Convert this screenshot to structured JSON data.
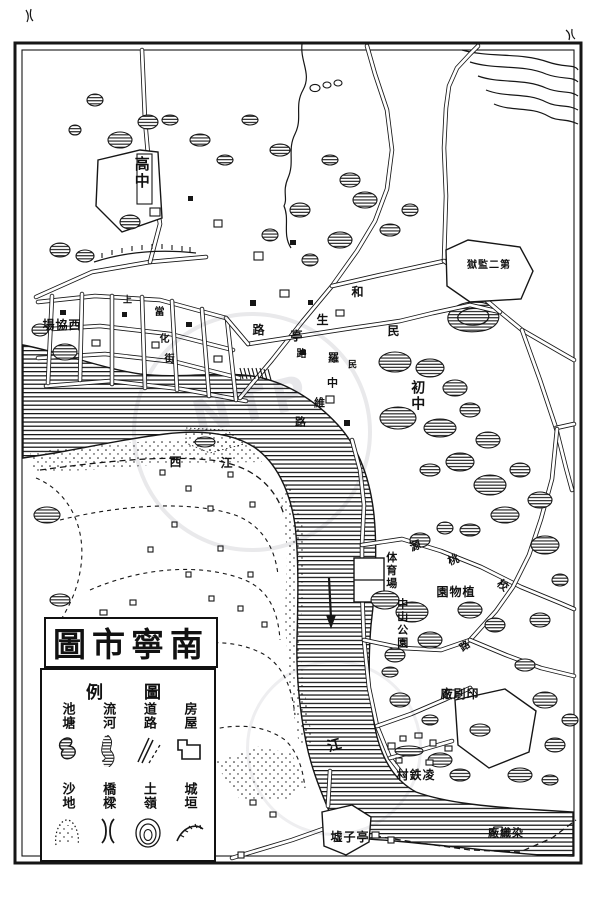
{
  "colors": {
    "ink": "#161616",
    "paper": "#ffffff"
  },
  "title": {
    "text": "圖市寧南"
  },
  "legend": {
    "header": {
      "right": "圖",
      "left": "例"
    },
    "rows": [
      {
        "items": [
          {
            "label": "房屋",
            "symbol": "house"
          },
          {
            "label": "道路",
            "symbol": "road"
          },
          {
            "label": "流河",
            "symbol": "river"
          },
          {
            "label": "池塘",
            "symbol": "pond"
          }
        ]
      },
      {
        "items": [
          {
            "label": "城垣",
            "symbol": "wall"
          },
          {
            "label": "土嶺",
            "symbol": "hill"
          },
          {
            "label": "橋樑",
            "symbol": "bridge"
          },
          {
            "label": "沙地",
            "symbol": "sand"
          }
        ]
      }
    ]
  },
  "watermark": {
    "text": "NTP"
  },
  "map": {
    "labels": [
      {
        "text": "高中",
        "x": 141,
        "y": 173,
        "vertical": true,
        "size": 15
      },
      {
        "text": "場協西",
        "x": 62,
        "y": 325,
        "size": 12
      },
      {
        "text": "獄監二第",
        "x": 489,
        "y": 266,
        "size": 10
      },
      {
        "text": "初中",
        "x": 417,
        "y": 396,
        "vertical": true,
        "size": 14
      },
      {
        "text": "和",
        "x": 358,
        "y": 292,
        "size": 12
      },
      {
        "text": "民",
        "x": 394,
        "y": 331,
        "size": 12
      },
      {
        "text": "生",
        "x": 323,
        "y": 320,
        "size": 12
      },
      {
        "text": "亭",
        "x": 297,
        "y": 336,
        "size": 12
      },
      {
        "text": "路",
        "x": 259,
        "y": 330,
        "size": 12
      },
      {
        "text": "路",
        "x": 302,
        "y": 355,
        "size": 10
      },
      {
        "text": "羅",
        "x": 334,
        "y": 358,
        "size": 11
      },
      {
        "text": "民",
        "x": 353,
        "y": 366,
        "size": 9
      },
      {
        "text": "中",
        "x": 333,
        "y": 383,
        "size": 11
      },
      {
        "text": "維",
        "x": 320,
        "y": 403,
        "size": 11
      },
      {
        "text": "路",
        "x": 301,
        "y": 422,
        "size": 11
      },
      {
        "text": "上",
        "x": 128,
        "y": 301,
        "size": 9
      },
      {
        "text": "當",
        "x": 160,
        "y": 313,
        "size": 10
      },
      {
        "text": "化",
        "x": 165,
        "y": 340,
        "size": 10
      },
      {
        "text": "街",
        "x": 170,
        "y": 360,
        "size": 10
      },
      {
        "text": "西",
        "x": 176,
        "y": 462,
        "size": 12
      },
      {
        "text": "江",
        "x": 227,
        "y": 463,
        "size": 12
      },
      {
        "text": "源",
        "x": 416,
        "y": 546,
        "size": 11,
        "rot": -20
      },
      {
        "text": "桃",
        "x": 454,
        "y": 560,
        "size": 11,
        "rot": -20
      },
      {
        "text": "体育場",
        "x": 391,
        "y": 571,
        "vertical": true,
        "size": 11
      },
      {
        "text": "園物植",
        "x": 456,
        "y": 592,
        "size": 12
      },
      {
        "text": "中山公園",
        "x": 402,
        "y": 624,
        "vertical": true,
        "size": 11
      },
      {
        "text": "校",
        "x": 503,
        "y": 586,
        "size": 11,
        "rot": 40
      },
      {
        "text": "路",
        "x": 466,
        "y": 647,
        "size": 10,
        "rot": -35
      },
      {
        "text": "廠刷印",
        "x": 460,
        "y": 694,
        "size": 12
      },
      {
        "text": "村鉄凌",
        "x": 416,
        "y": 775,
        "size": 12
      },
      {
        "text": "廠織染",
        "x": 506,
        "y": 833,
        "size": 11
      },
      {
        "text": "墟子亭",
        "x": 350,
        "y": 837,
        "size": 12
      },
      {
        "text": "江",
        "x": 335,
        "y": 746,
        "size": 14,
        "rot": -15
      }
    ]
  }
}
